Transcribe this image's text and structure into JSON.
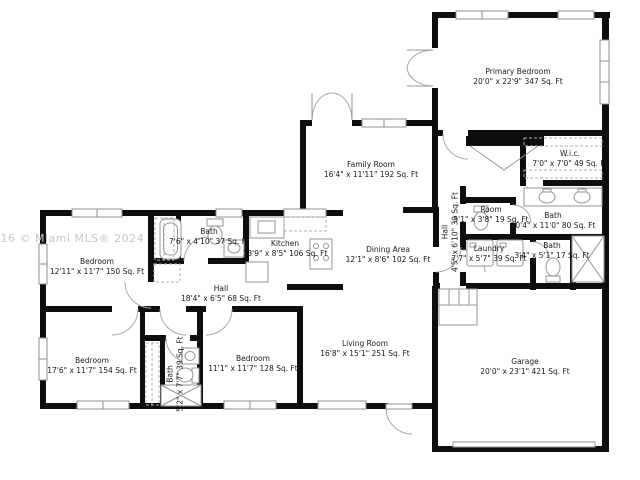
{
  "watermark": {
    "text": "016 © Miami MLS® 2024"
  },
  "plan": {
    "rooms": [
      {
        "id": "primary-bedroom",
        "name": "Primary Bedroom",
        "dims": "20'0\" x 22'9\" 347 Sq. Ft"
      },
      {
        "id": "wic",
        "name": "W.i.c.",
        "dims": "7'0\" x 7'0\" 49 Sq. Ft"
      },
      {
        "id": "family-room",
        "name": "Family Room",
        "dims": "16'4\" x 11'11\" 192 Sq. Ft"
      },
      {
        "id": "room-19",
        "name": "Room",
        "dims": "5'1\" x 3'8\" 19 Sq. Ft"
      },
      {
        "id": "bath-80",
        "name": "Bath",
        "dims": "10'4\" x 11'0\" 80 Sq. Ft"
      },
      {
        "id": "hall-30",
        "name": "Hall",
        "dims": "4'5\" x 6'10\" 30 Sq. Ft"
      },
      {
        "id": "laundry",
        "name": "Laundry",
        "dims": "7'7\" x 5'7\" 39 Sq. Ft"
      },
      {
        "id": "bath-17",
        "name": "Bath",
        "dims": "3'4\" x 5'1\" 17 Sq. Ft"
      },
      {
        "id": "bedroom-150",
        "name": "Bedroom",
        "dims": "12'11\" x 11'7\" 150 Sq. Ft"
      },
      {
        "id": "bath-37",
        "name": "Bath",
        "dims": "7'6\" x 4'10\" 37 Sq. Ft"
      },
      {
        "id": "kitchen",
        "name": "Kitchen",
        "dims": "13'9\" x 8'5\" 106 Sq. Ft"
      },
      {
        "id": "dining-area",
        "name": "Dining Area",
        "dims": "12'1\" x 8'6\" 102 Sq. Ft"
      },
      {
        "id": "hall-68",
        "name": "Hall",
        "dims": "18'4\" x 6'5\" 68 Sq. Ft"
      },
      {
        "id": "bedroom-154",
        "name": "Bedroom",
        "dims": "17'6\" x 11'7\" 154 Sq. Ft"
      },
      {
        "id": "bath-39",
        "name": "Bath",
        "dims": "5'2\" x 7'7\" 39 Sq. Ft"
      },
      {
        "id": "bedroom-128",
        "name": "Bedroom",
        "dims": "11'1\" x 11'7\" 128 Sq. Ft"
      },
      {
        "id": "living-room",
        "name": "Living Room",
        "dims": "16'8\" x 15'1\" 251 Sq. Ft"
      },
      {
        "id": "garage",
        "name": "Garage",
        "dims": "20'0\" x 23'1\" 421 Sq. Ft"
      }
    ]
  },
  "colors": {
    "wall": "#0e0e0e",
    "fixture": "#969696",
    "label": "#1a1a1a",
    "watermark": "#c7c7c7"
  }
}
